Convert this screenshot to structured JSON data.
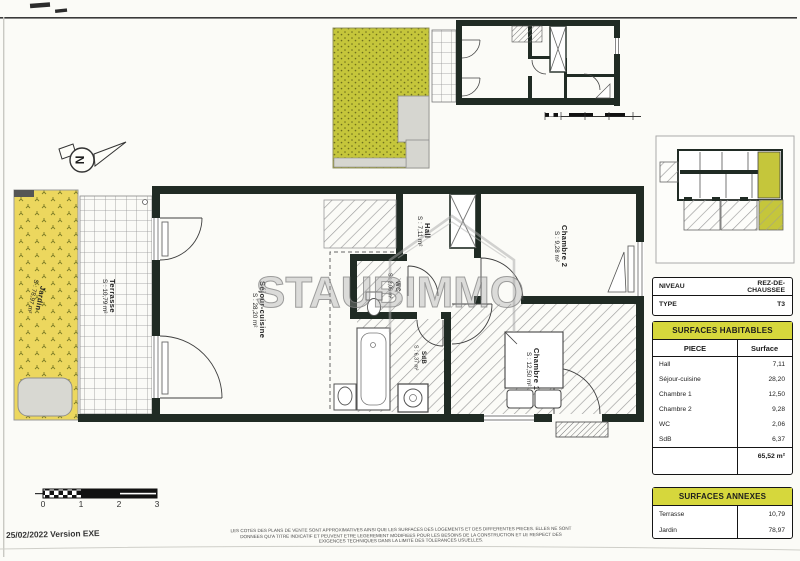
{
  "page": {
    "date_version": "25/02/2022 Version EXE",
    "disclaimer": [
      "LES COTES DES PLANS DE VENTE SONT APPROXIMATIVES AINSI QUE LES SURFACES DES LOGEMENTS ET DES DIFFERENTES PIECES. ELLES NE SONT",
      "DONNEES QU'A TITRE INDICATIF ET PEUVENT ETRE LEGEREMENT MODIFIEES POUR LES BESOINS DE LA CONSTRUCTION ET LE RESPECT DES",
      "EXIGENCES TECHNIQUES DANS LA LIMITE DES TOLERANCES USUELLES."
    ]
  },
  "watermark": {
    "text": "STAUBIMMO"
  },
  "compass": {
    "label": "N"
  },
  "scale_bar": {
    "labels": [
      "0",
      "1",
      "2",
      "3"
    ]
  },
  "info_table": {
    "rows": [
      {
        "label": "NIVEAU",
        "value": "REZ-DE-CHAUSSEE"
      },
      {
        "label": "TYPE",
        "value": "T3"
      }
    ]
  },
  "surfaces_habitables": {
    "title": "SURFACES HABITABLES",
    "col_piece": "PIECE",
    "col_surface": "Surface",
    "rows": [
      {
        "piece": "Hall",
        "surface": "7,11"
      },
      {
        "piece": "Séjour-cuisine",
        "surface": "28,20"
      },
      {
        "piece": "Chambre 1",
        "surface": "12,50"
      },
      {
        "piece": "Chambre 2",
        "surface": "9,28"
      },
      {
        "piece": "WC",
        "surface": "2,06"
      },
      {
        "piece": "SdB",
        "surface": "6,37"
      }
    ],
    "total": "65,52 m²"
  },
  "surfaces_annexes": {
    "title": "SURFACES ANNEXES",
    "rows": [
      {
        "piece": "Terrasse",
        "surface": "10,79"
      },
      {
        "piece": "Jardin",
        "surface": "78,97"
      }
    ]
  },
  "rooms": {
    "jardin": {
      "name": "Jardin",
      "area": "S : 78,97 m²"
    },
    "terrasse": {
      "name": "Terrasse",
      "area": "S : 10,79 m²"
    },
    "sejour": {
      "name": "Séjour-cuisine",
      "area": "S : 28,20 m²"
    },
    "hall": {
      "name": "Hall",
      "area": "S : 7,11 m²"
    },
    "wc": {
      "name": "WC",
      "area": "S : 2,06 m²"
    },
    "sdb": {
      "name": "SdB",
      "area": "S : 6,37 m²"
    },
    "chambre1": {
      "name": "Chambre 1",
      "area": "S : 12,50 m²"
    },
    "chambre2": {
      "name": "Chambre 2",
      "area": "S : 9,28 m²"
    }
  },
  "colors": {
    "wall": "#202b24",
    "header_yellow": "#d6d73c",
    "garden_olive": "#c5c63b",
    "garden_yellow": "#ecd75e"
  }
}
